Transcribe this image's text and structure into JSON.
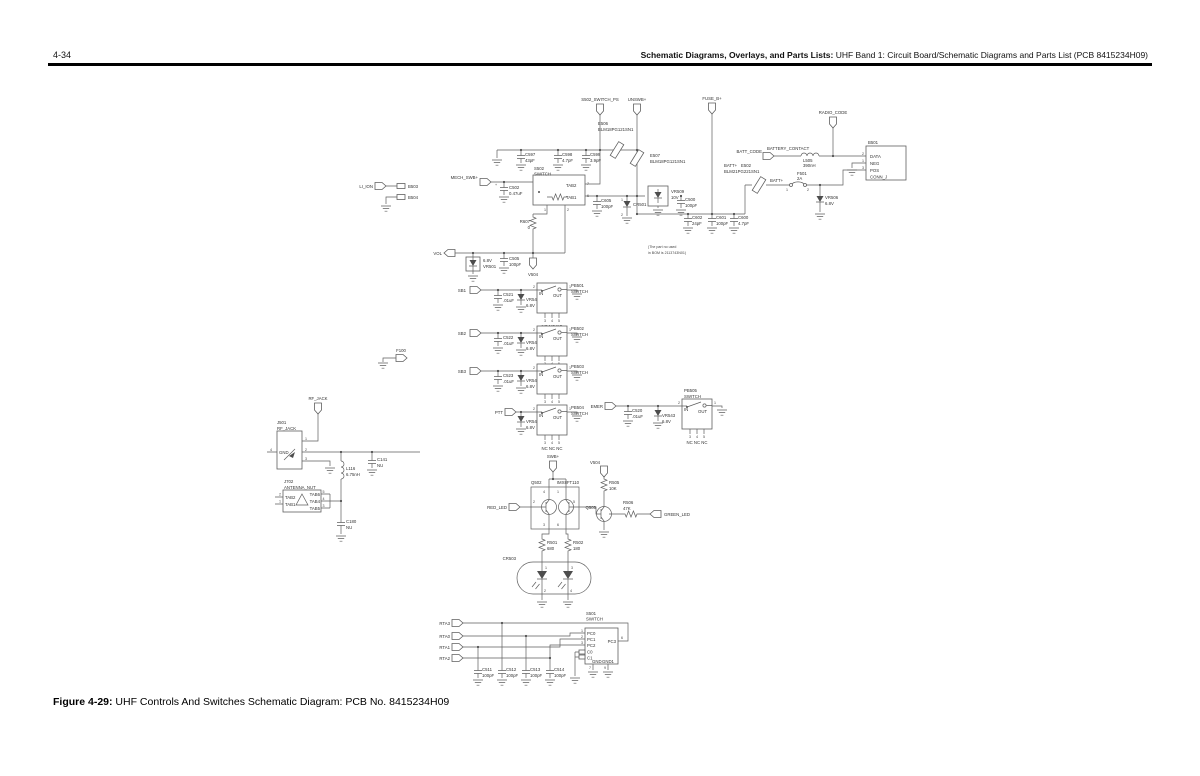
{
  "header": {
    "page_number": "4-34",
    "title_bold": "Schematic Diagrams, Overlays, and Parts Lists:",
    "title_rest": " UHF Band 1: Circuit Board/Schematic Diagrams and Parts List (PCB 8415234H09)"
  },
  "footer": {
    "figure_label": "Figure 4-29:",
    "caption": " UHF Controls And Switches Schematic Diagram: PCB No. 8415234H09"
  },
  "schematic": {
    "labels": {
      "s502_switch_ps": "S502_SWITCH_PS",
      "unswb": "UNSWB+",
      "fuse_b": "FUSE_B+",
      "radio_code": "RADIO_CODE",
      "li_ion": "LI_ION",
      "b503": "B503",
      "b504": "B504",
      "mech_swb": "MECH_SWB+",
      "vol": "VOL",
      "v504": "V504",
      "swb": "SWB+",
      "batt_code": "BATT_CODE",
      "battery_contact": "BATTERY_CONTACT",
      "batt_plus": "BATT+",
      "sb1": "SB1",
      "sb2": "SB2",
      "sb3": "SB3",
      "ptt": "PTT",
      "emer": "EMER",
      "f100": "F100",
      "rf_jack": "RF_JACK",
      "red_led": "RED_LED",
      "green_led": "GREEN_LED",
      "rta0": "RTA0",
      "rta1": "RTA1",
      "rta2": "RTA2",
      "rta3": "RTA3",
      "e506_ref": "E506",
      "e507_ref": "E507",
      "blm18": "BLM18PG121SN1",
      "e502_ref": "E502",
      "e502_val": "BLM21PG221SN1",
      "c597_ref": "C597",
      "c597_val": "43pF",
      "c598_ref": "C598",
      "v47": "4.7pF",
      "c599_ref": "C599",
      "c599_val": "3.9pF",
      "c502_ref": "C502",
      "c502_val": "0.47uF",
      "plus": "+",
      "s502_ref": "S502",
      "switch": "SWITCH",
      "tab1": "TAB1",
      "tab2": "TAB2",
      "tab4": "TAB4",
      "tab5": "TAB5",
      "tab6": "TAB6",
      "r607_ref": "R607",
      "r607_val": "0",
      "c605_ref": "C605",
      "v100": "100pF",
      "vr501_ref": "VR501",
      "v68": "6.8V",
      "c505_ref": "C505",
      "vr509_ref": "VR509",
      "vr509_val": "10V",
      "c500_ref": "C500",
      "cr501_ref": "CR501",
      "c602_ref": "C602",
      "c602_val": "24pF",
      "c601_ref": "C601",
      "c600_ref": "C600",
      "f501_ref": "F501",
      "f501_val": "2A",
      "l505_ref": "L505",
      "l505_val": "390nH",
      "b501_ref": "B501",
      "pin_data": "DATA",
      "pin_neg": "NEG",
      "pin_pos": "POS",
      "conn_j": "CONN_J",
      "vr506_ref": "VR506",
      "note1": "(The part no used",
      "note2": "in BOM is 2113743N01)",
      "c520_ref": "C520",
      "c521_ref": "C521",
      "c522_ref": "C522",
      "c523_ref": "C523",
      "v01": ".01uF",
      "vr540_ref": "VR540",
      "vr541_ref": "VR541",
      "vr542_ref": "VR542",
      "vr543_ref": "VR543",
      "vr544_ref": "VR544",
      "pb501": "PB501",
      "pb502": "PB502",
      "pb503": "PB503",
      "pb504": "PB504",
      "pb505": "PB505",
      "in_lbl": "IN",
      "out_lbl": "OUT",
      "nc": "NC NC NC",
      "j501_ref": "J501",
      "gnd_lbl": "GND",
      "l116_ref": "L116",
      "l116_val": "6.75nH",
      "c141_ref": "C141",
      "nu": "NU",
      "j702_ref": "J702",
      "j702_val": "ANTENNA_NUT",
      "c180_ref": "C180",
      "q502_ref": "Q502",
      "q502_val": "IMX8FT110",
      "r505_ref": "R505",
      "r505_val": "10K",
      "q505_ref": "Q505",
      "r506_ref": "R506",
      "r506_val": "47K",
      "r501_ref": "R501",
      "r501_val": "680",
      "r502_ref": "R502",
      "r502_val": "180",
      "cr503_ref": "CR503",
      "s501_ref": "S501",
      "pc0": "PC0",
      "pc1": "PC1",
      "pc2": "PC2",
      "pc3": "PC3",
      "c0": "C0",
      "c1": "C1",
      "gnd1": "GND1",
      "c511_ref": "C511",
      "c512_ref": "C512",
      "c513_ref": "C513",
      "c514_ref": "C514",
      "d1": "1",
      "d2": "2",
      "d3": "3",
      "d4": "4",
      "d5": "5",
      "d6": "6",
      "d7": "7",
      "d8": "8",
      "d9": "9"
    }
  }
}
